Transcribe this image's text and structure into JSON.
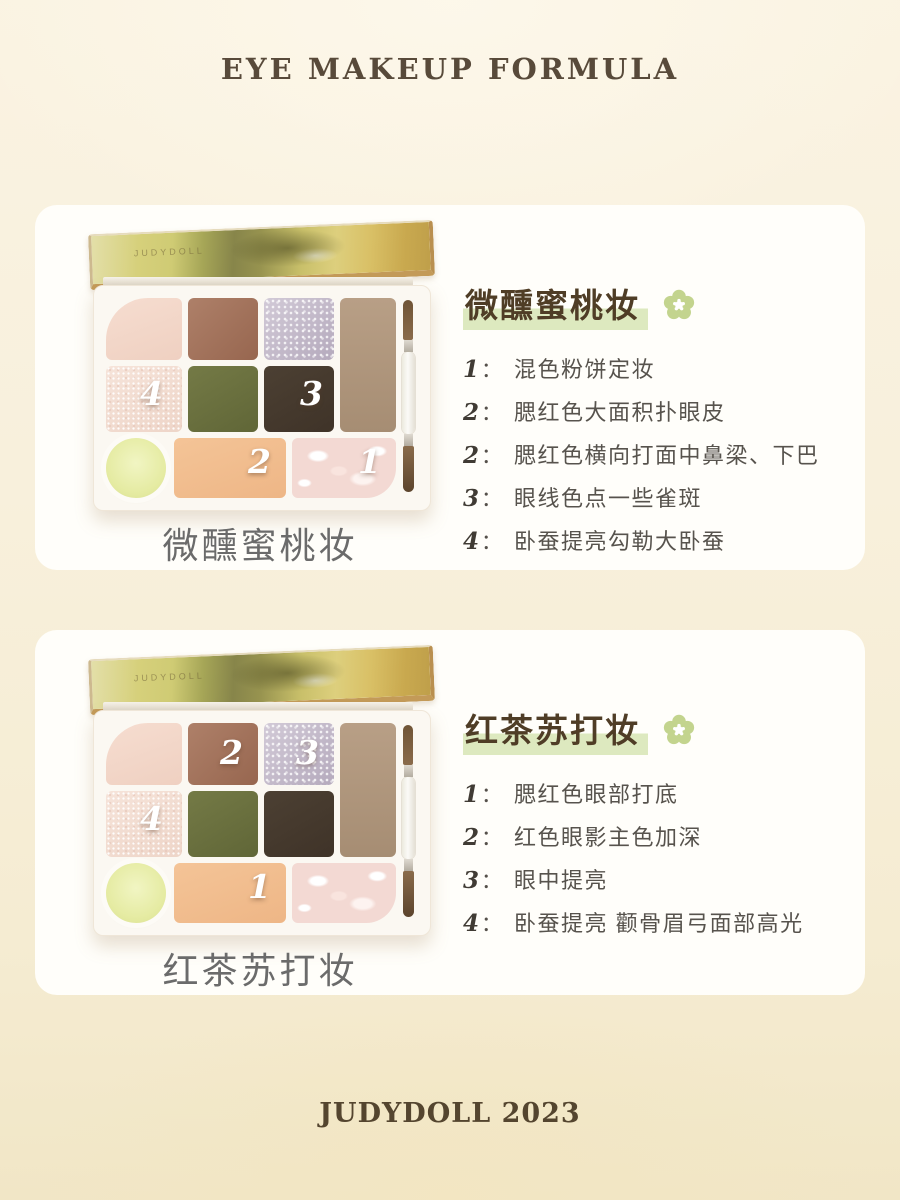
{
  "page": {
    "title": "EYE MAKEUP FORMULA",
    "footer": "JUDYDOLL 2023"
  },
  "misc": {
    "colon": "：",
    "lid_brand": "JUDYDOLL"
  },
  "colors": {
    "background_cream": "#f7efdb",
    "card_white": "#fffefa",
    "title_brown": "#584a3a",
    "heading_brown": "#4f3d26",
    "step_text_gray": "#57534d",
    "caption_gray": "#6b6b6b",
    "highlight_green": "#dde9bf",
    "flower_green": "#c3d48e",
    "pan_peach": "#f2bf93",
    "pan_olive": "#6b713f",
    "pan_dark_brown": "#463a2e",
    "pan_glitter_lilac": "#c3bac8",
    "pan_yellow_green": "#e7edb0"
  },
  "sections": [
    {
      "title": "微醺蜜桃妆",
      "palette_label": "微醺蜜桃妆",
      "steps": [
        {
          "num": "1",
          "text": "混色粉饼定妆"
        },
        {
          "num": "2",
          "text": "腮红色大面积扑眼皮"
        },
        {
          "num": "2",
          "text": "腮红色横向打面中鼻梁、下巴"
        },
        {
          "num": "3",
          "text": "眼线色点一些雀斑"
        },
        {
          "num": "4",
          "text": "卧蚕提亮勾勒大卧蚕"
        }
      ],
      "pan_numbers": {
        "shimmer": "4",
        "dark": "3",
        "peach": "2",
        "marble": "1"
      }
    },
    {
      "title": "红茶苏打妆",
      "palette_label": "红茶苏打妆",
      "steps": [
        {
          "num": "1",
          "text": "腮红色眼部打底"
        },
        {
          "num": "2",
          "text": "红色眼影主色加深"
        },
        {
          "num": "3",
          "text": "眼中提亮"
        },
        {
          "num": "4",
          "text": "卧蚕提亮 颧骨眉弓面部高光"
        }
      ],
      "pan_numbers": {
        "brown": "2",
        "glitter": "3",
        "shimmer": "4",
        "peach": "1"
      }
    }
  ]
}
